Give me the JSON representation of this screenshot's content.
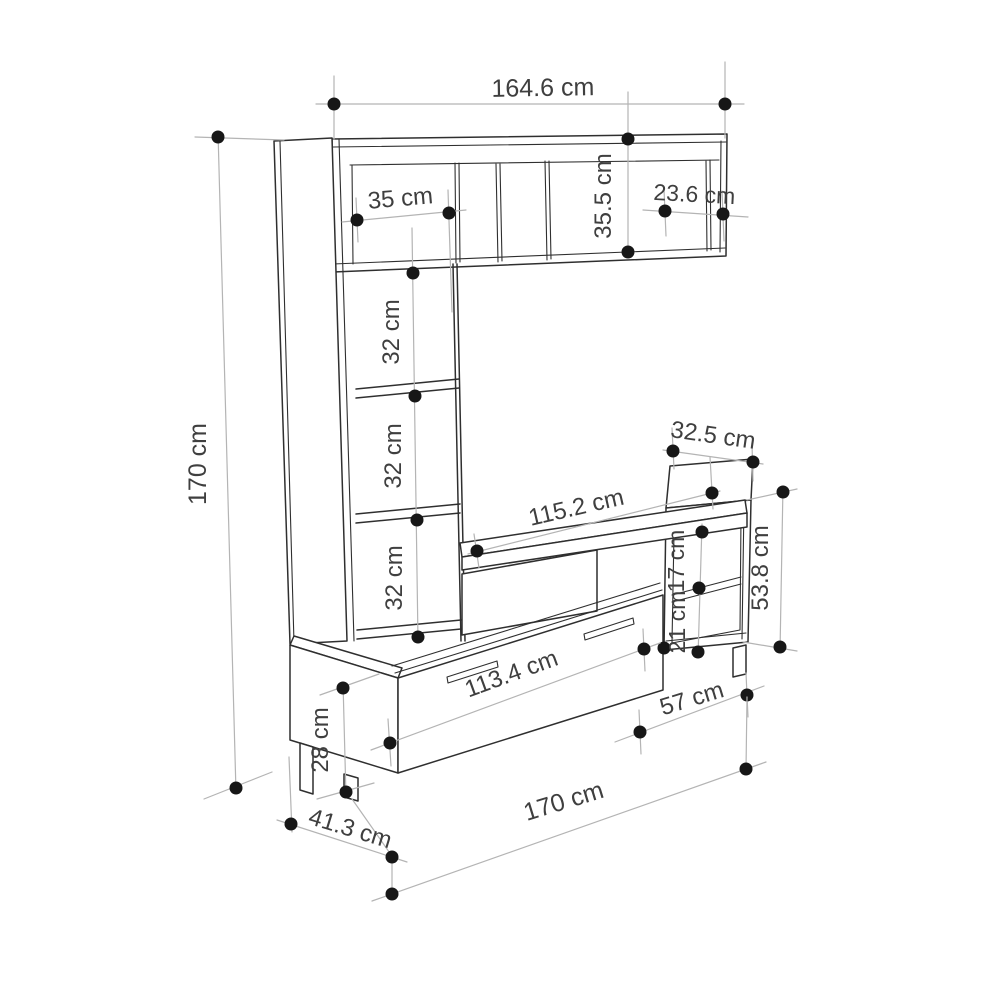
{
  "drawing": {
    "type": "furniture technical drawing",
    "subject": "TV wall unit with shelves and drawers, perspective view with dimension callouts",
    "unit": "cm",
    "colors": {
      "background": "#ffffff",
      "outline": "#2f2f2f",
      "dimension_line": "#b4b4b4",
      "marker": "#171717",
      "label_text": "#3f3f3f"
    }
  },
  "dimensions": {
    "top_width": {
      "label": "164.6 cm",
      "value": 164.6
    },
    "upper_left_compartment": {
      "label": "35 cm",
      "value": 35
    },
    "upper_cabinet_height": {
      "label": "35.5 cm",
      "value": 35.5
    },
    "upper_right_compartment": {
      "label": "23.6 cm",
      "value": 23.6
    },
    "total_height": {
      "label": "170 cm",
      "value": 170
    },
    "cubby_top": {
      "label": "32 cm",
      "value": 32
    },
    "cubby_middle": {
      "label": "32 cm",
      "value": 32
    },
    "cubby_bottom": {
      "label": "32 cm",
      "value": 32
    },
    "tv_shelf_width": {
      "label": "115.2 cm",
      "value": 115.2
    },
    "right_depth": {
      "label": "32.5 cm",
      "value": 32.5
    },
    "right_upper_compartment": {
      "label": "17 cm",
      "value": 17
    },
    "right_lower_compartment": {
      "label": "21 cm",
      "value": 21
    },
    "right_cabinet_height": {
      "label": "53.8 cm",
      "value": 53.8
    },
    "drawer_width": {
      "label": "113.4 cm",
      "value": 113.4
    },
    "right_base_width": {
      "label": "57 cm",
      "value": 57
    },
    "base_height": {
      "label": "28 cm",
      "value": 28
    },
    "base_depth": {
      "label": "41.3 cm",
      "value": 41.3
    },
    "total_width": {
      "label": "170 cm",
      "value": 170
    }
  }
}
